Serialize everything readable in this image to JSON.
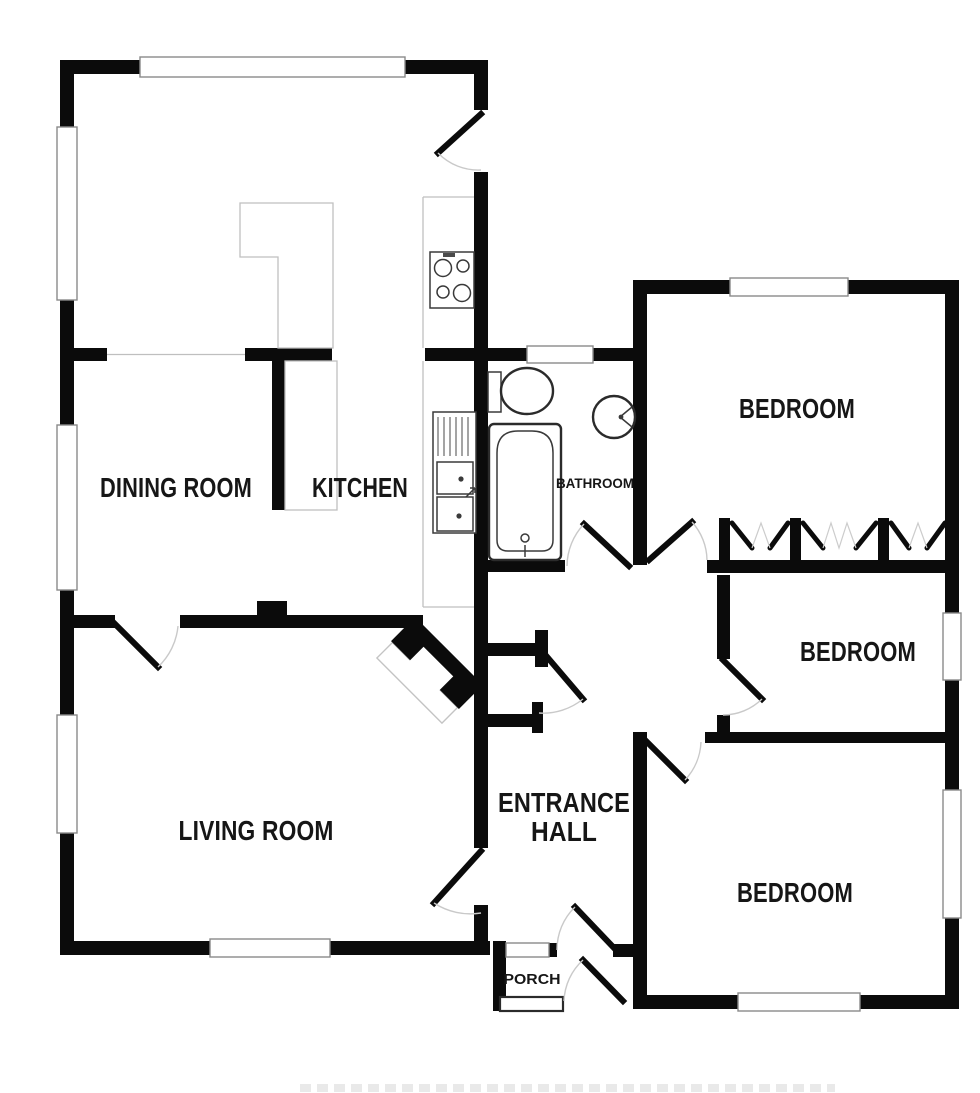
{
  "floorplan": {
    "title": "Bungalow floor plan",
    "rooms": [
      {
        "id": "dining-room",
        "label": "DINING ROOM"
      },
      {
        "id": "kitchen",
        "label": "KITCHEN"
      },
      {
        "id": "living-room",
        "label": "LIVING ROOM"
      },
      {
        "id": "bathroom",
        "label": "BATHROOM"
      },
      {
        "id": "bedroom-1",
        "label": "BEDROOM"
      },
      {
        "id": "bedroom-2",
        "label": "BEDROOM"
      },
      {
        "id": "bedroom-3",
        "label": "BEDROOM"
      },
      {
        "id": "entrance-hall",
        "label": "ENTRANCE HALL",
        "lines": [
          "ENTRANCE",
          "HALL"
        ]
      },
      {
        "id": "porch",
        "label": "PORCH"
      }
    ],
    "fixtures": [
      "toilet-icon",
      "bathtub-icon",
      "washbasin-icon",
      "hob-icon",
      "kitchen-sink-icon",
      "worktop-icon",
      "fireplace-icon",
      "built-in-wardrobe-icon",
      "door-swing-icon",
      "window-icon"
    ],
    "colors": {
      "wall": "#0b0b0b",
      "background": "#ffffff",
      "fixture_outline": "#2b2b2b",
      "light_line": "#bfbfbf",
      "window_outline": "#8a8a8a",
      "text": "#161616"
    }
  }
}
